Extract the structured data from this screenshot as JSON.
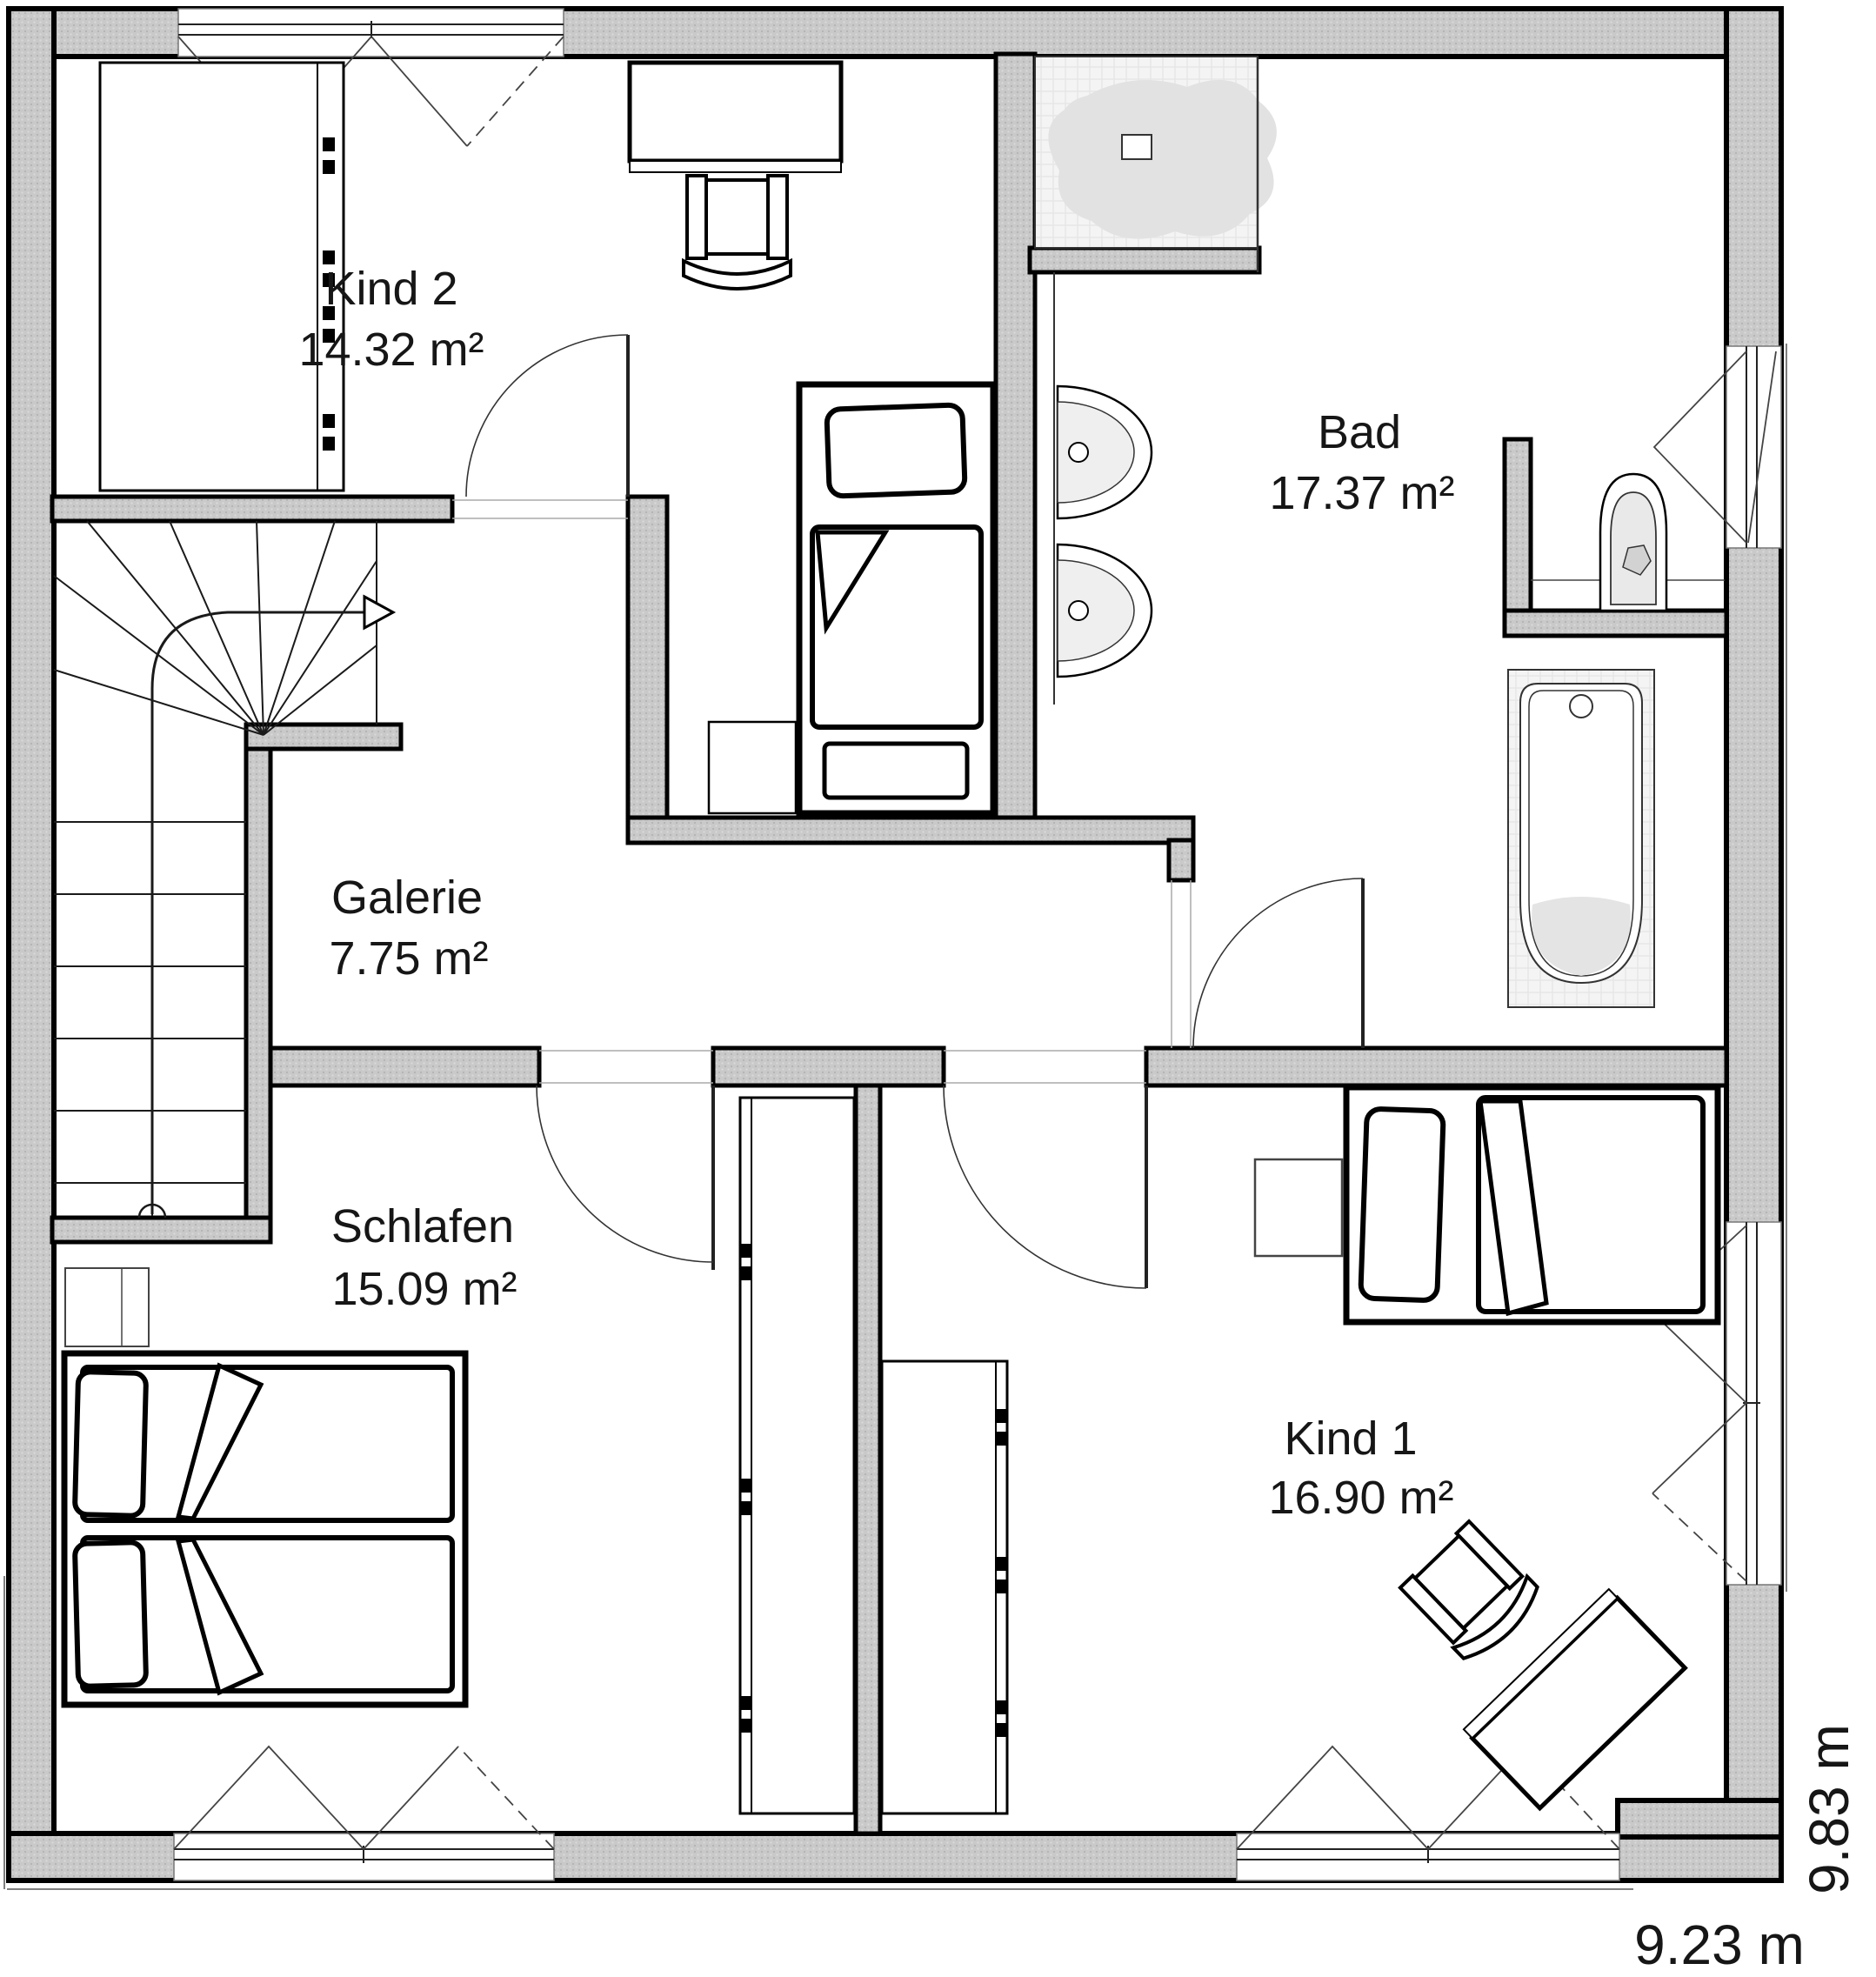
{
  "floor_plan": {
    "rooms": [
      {
        "id": "kind2",
        "name": "Kind 2",
        "area": "14.32 m²"
      },
      {
        "id": "bad",
        "name": "Bad",
        "area": "17.37 m²"
      },
      {
        "id": "galerie",
        "name": "Galerie",
        "area": "7.75 m²"
      },
      {
        "id": "schlafen",
        "name": "Schlafen",
        "area": "15.09 m²"
      },
      {
        "id": "kind1",
        "name": "Kind 1",
        "area": "16.90 m²"
      }
    ],
    "dimensions": {
      "width": "9.23 m",
      "height": "9.83 m"
    },
    "colors": {
      "wall_fill": "#c9c9c9",
      "line": "#000000",
      "fixture_fill": "#f2f2f2",
      "accent_gray": "#e3e3e3",
      "background": "#ffffff"
    }
  }
}
